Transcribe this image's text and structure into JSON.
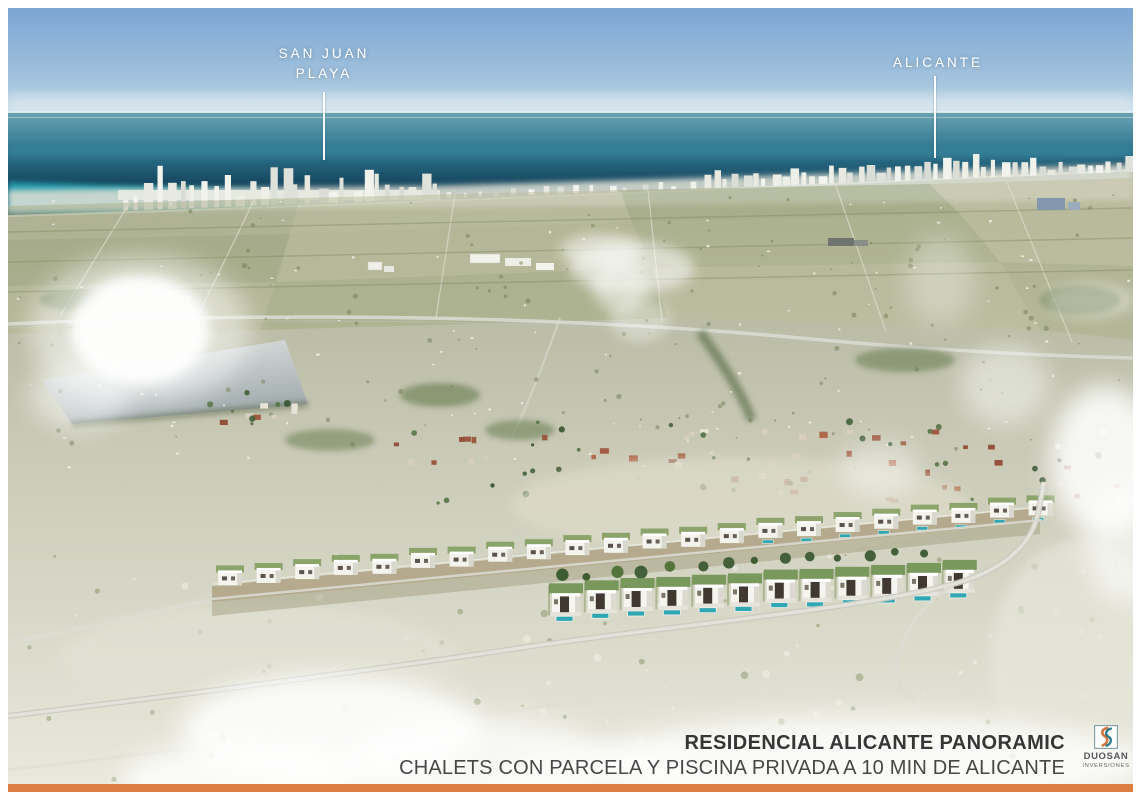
{
  "annotations": {
    "san_juan": {
      "line1": "SAN JUAN",
      "line2": "PLAYA"
    },
    "alicante": {
      "label": "ALICANTE"
    }
  },
  "caption": {
    "title": "RESIDENCIAL ALICANTE PANORAMIC",
    "subtitle": "CHALETS CON PARCELA Y PISCINA PRIVADA A 10 MIN DE ALICANTE"
  },
  "logo": {
    "name": "DUOSAN",
    "subname": "INVERSIONES",
    "monogram_icon": "double-s-monogram"
  },
  "colors": {
    "accent_orange": "#dc7e42",
    "brand_teal": "#2e7c8a",
    "brand_orange_s": "#d4763b",
    "sky_top": "#7ba5d3",
    "sky_horizon": "#cfe2ec",
    "sea_deep": "#0c3144",
    "sea_shallow": "#27aebb",
    "pool_teal": "#2fa8b4",
    "title_text": "#363636",
    "label_text": "#ffffff"
  }
}
